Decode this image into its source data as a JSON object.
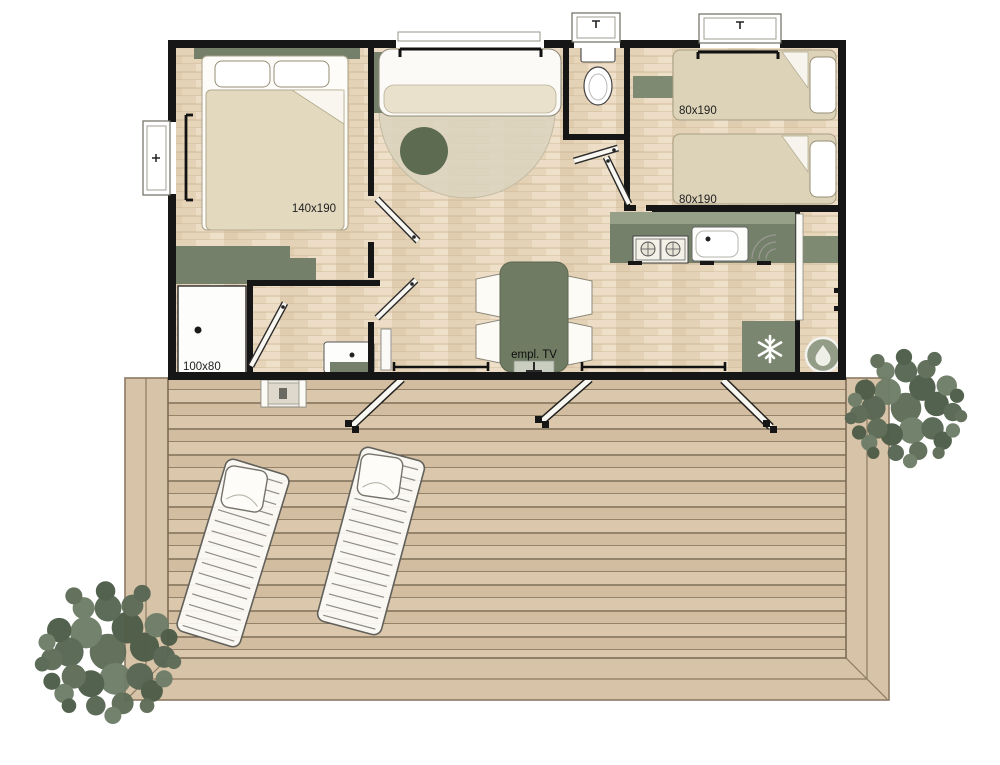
{
  "floorplan": {
    "master_bedroom": {
      "bed_size": "140x190"
    },
    "twin_bedroom": {
      "bed1_size": "80x190",
      "bed2_size": "80x190"
    },
    "bathroom": {
      "shower_size": "100x80"
    },
    "living_room": {
      "tv_spot_label": "empl. TV"
    },
    "icons": {
      "fridge": "snowflake-icon",
      "water_heater": "droplet-icon",
      "tv_mount": "tv-mount-icon"
    },
    "colors": {
      "wall": "#161616",
      "furniture_green": "#75806a",
      "furniture_green_light": "#96a088",
      "floor_wood": "#e9d8bf",
      "deck_wood": "#d8c4a8",
      "linen_beige": "#e3d9bf"
    }
  }
}
